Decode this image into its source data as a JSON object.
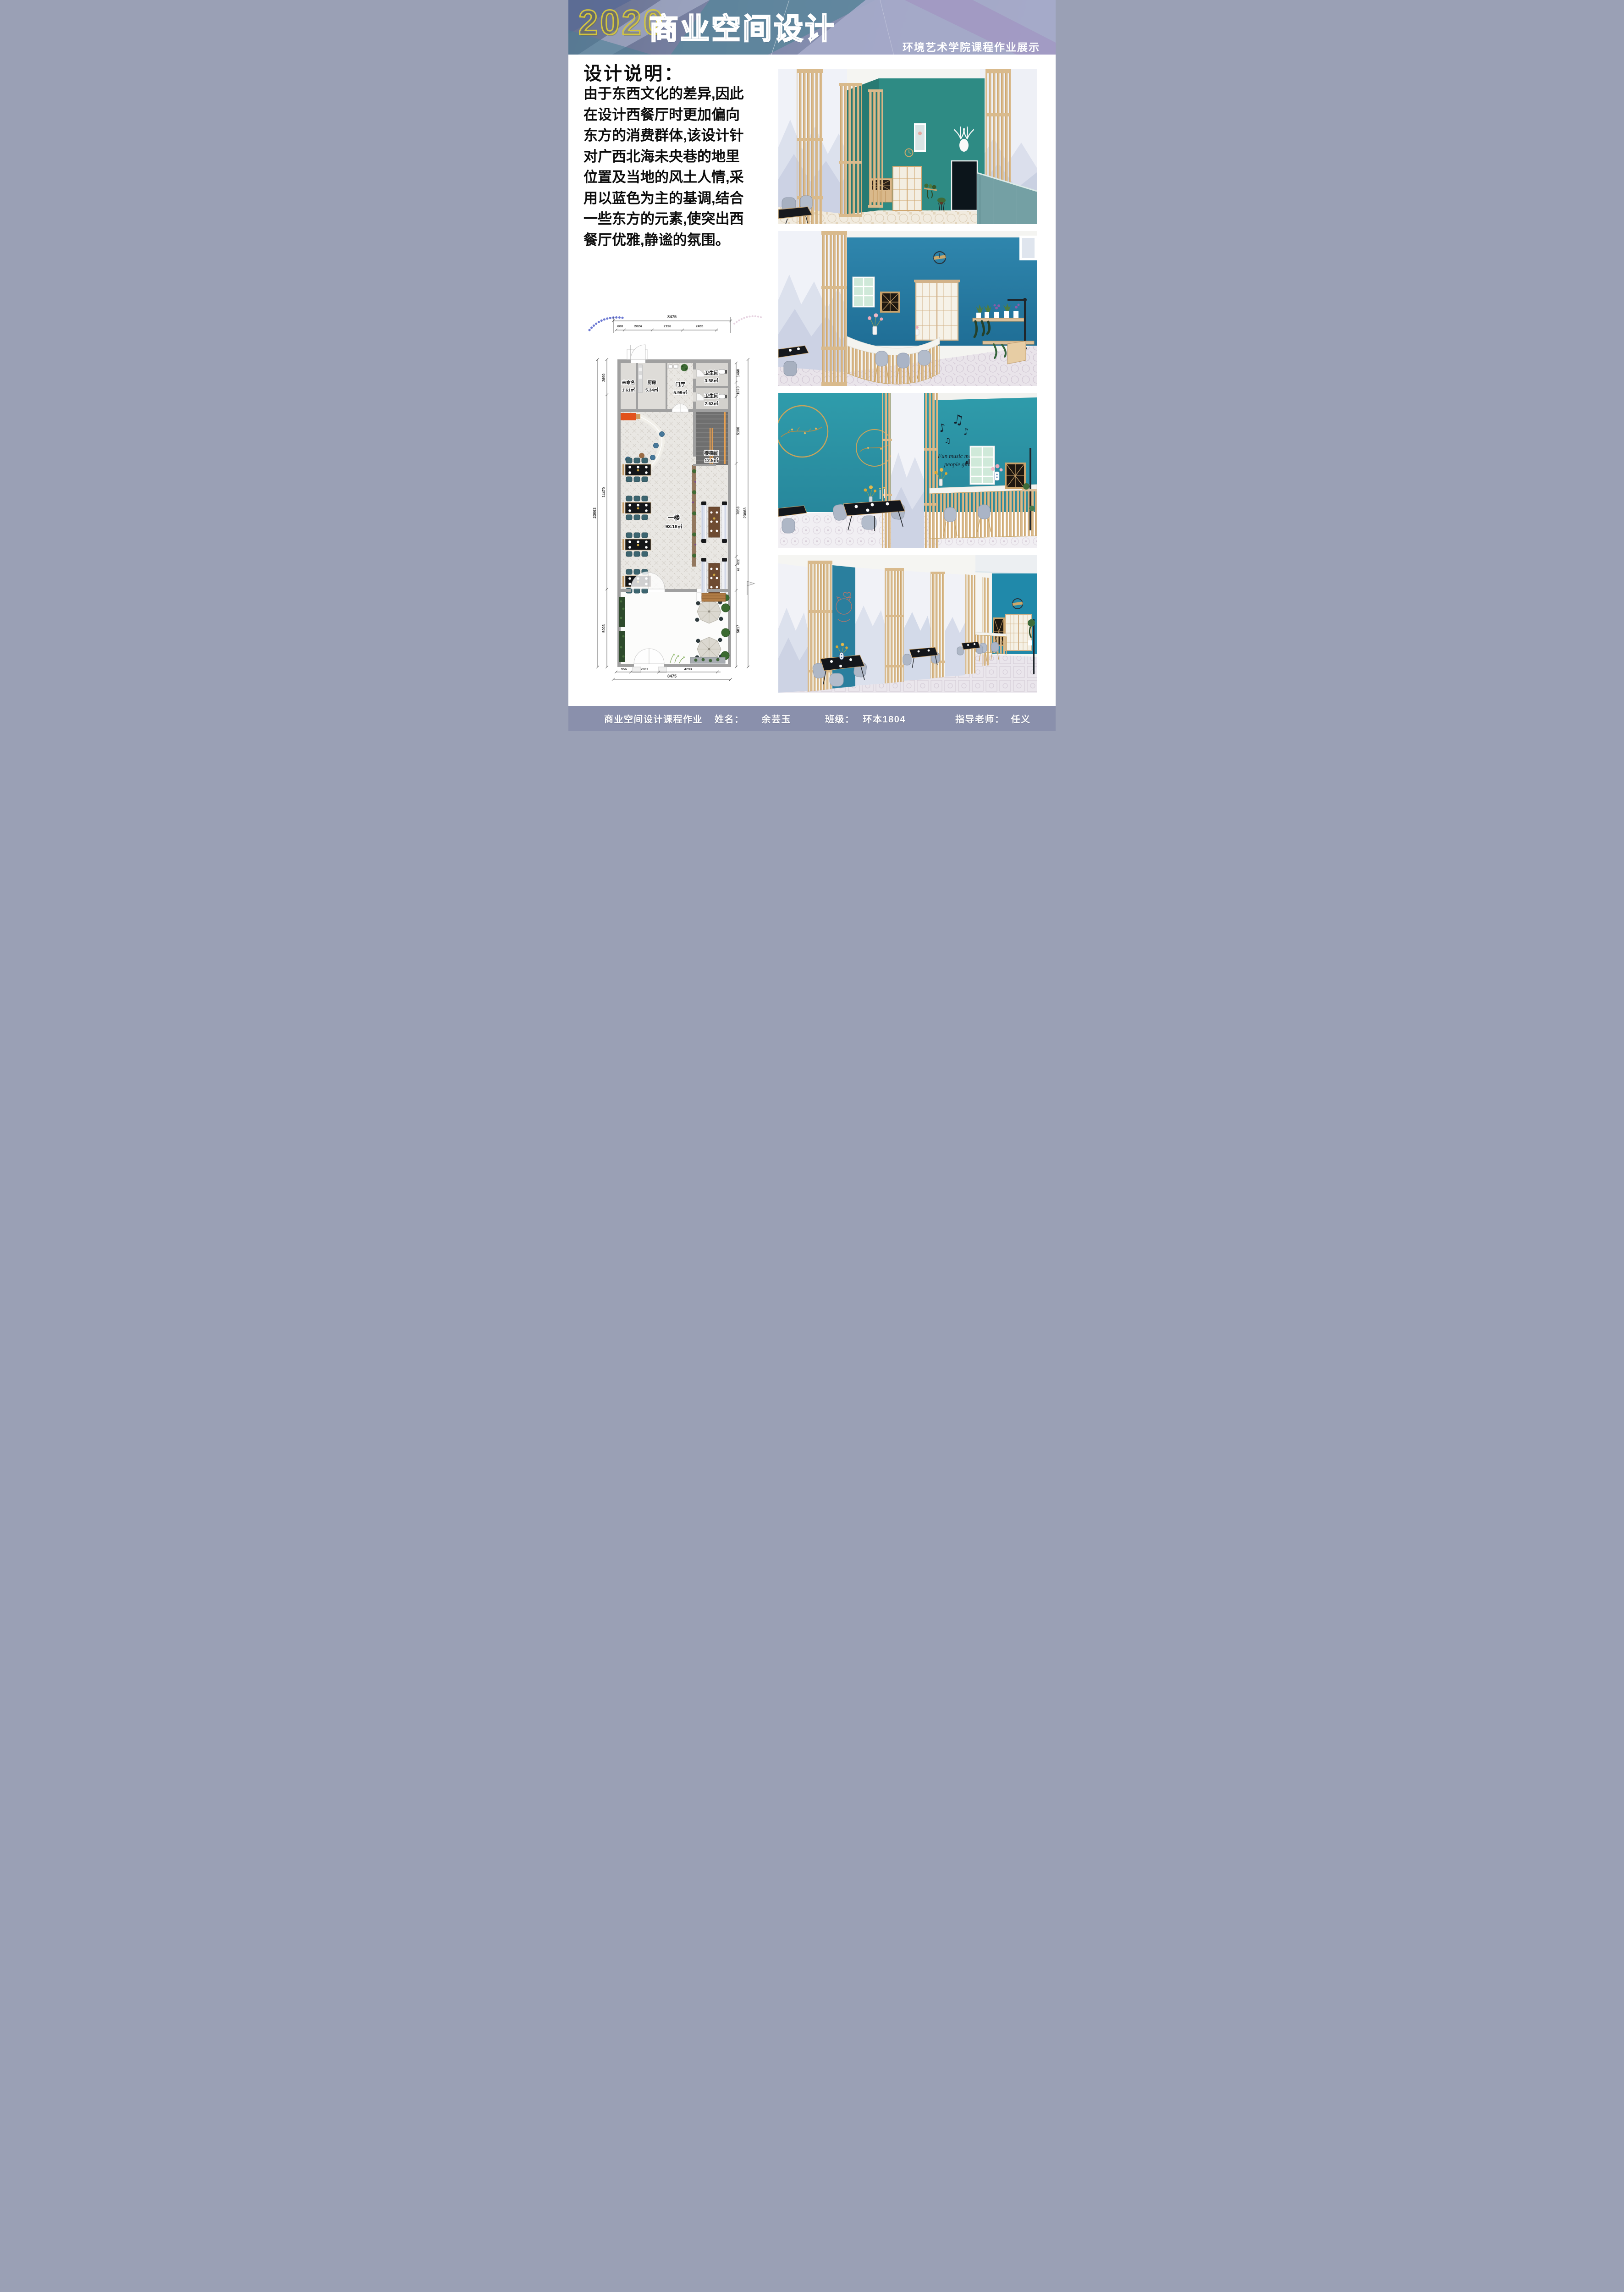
{
  "colors": {
    "header-bg": "#7e87a9",
    "accent-yellow": "#d3c53e",
    "teal-wall": "#2e8b84",
    "blue-wall": "#2a7fa8",
    "cyan-wall": "#2d97a8",
    "wood": "#d9ba8c",
    "footer-bg": "#8a90ac"
  },
  "header": {
    "year": "2020",
    "title": "商业空间设计",
    "subtitle": "环境艺术学院课程作业展示"
  },
  "description": {
    "heading": "设计说明：",
    "lines": [
      "由于东西文化的差异,因此",
      "在设计西餐厅时更加偏向",
      "东方的消费群体,该设计针",
      "对广西北海未央巷的地里",
      "位置及当地的风土人情,采",
      "用以蓝色为主的基调,结合",
      "一些东方的元素,使突出西",
      "餐厅优雅,静谧的氛围。"
    ]
  },
  "plan": {
    "rooms": {
      "unnamed": {
        "name": "未命名",
        "area": "1.61㎡"
      },
      "kitchen": {
        "name": "厨房",
        "area": "5.34㎡"
      },
      "foyer": {
        "name": "门厅",
        "area": "5.99㎡"
      },
      "bath1": {
        "name": "卫生间",
        "area": "3.58㎡"
      },
      "bath2": {
        "name": "卫生间",
        "area": "2.63㎡"
      },
      "stair": {
        "name": "楼梯间",
        "area": "12.5㎡"
      },
      "hall": {
        "name": "一楼",
        "area": "93.18㎡"
      }
    },
    "dims": {
      "top_total": "8475",
      "top": [
        "600",
        "2024",
        "2196",
        "2455"
      ],
      "left": [
        "2690",
        "14470",
        "5003"
      ],
      "left_total": "23063",
      "right": [
        "1460",
        "1070",
        "5100",
        "7053",
        "622",
        "61",
        "5817"
      ],
      "right_total": "23063",
      "bottom": [
        "956",
        "2037",
        "4293"
      ],
      "bottom_total": "8475"
    }
  },
  "renders": {
    "music_notes": [
      "♪",
      "♫",
      "♪",
      "♫"
    ],
    "music_text_line1": "Fun music makes",
    "music_text_line2": "people glad"
  },
  "footer": {
    "course": "商业空间设计课程作业",
    "name_label": "姓名：",
    "name": "余芸玉",
    "class_label": "班级：",
    "class_value": "环本1804",
    "teacher_label": "指导老师：",
    "teacher": "任义"
  }
}
